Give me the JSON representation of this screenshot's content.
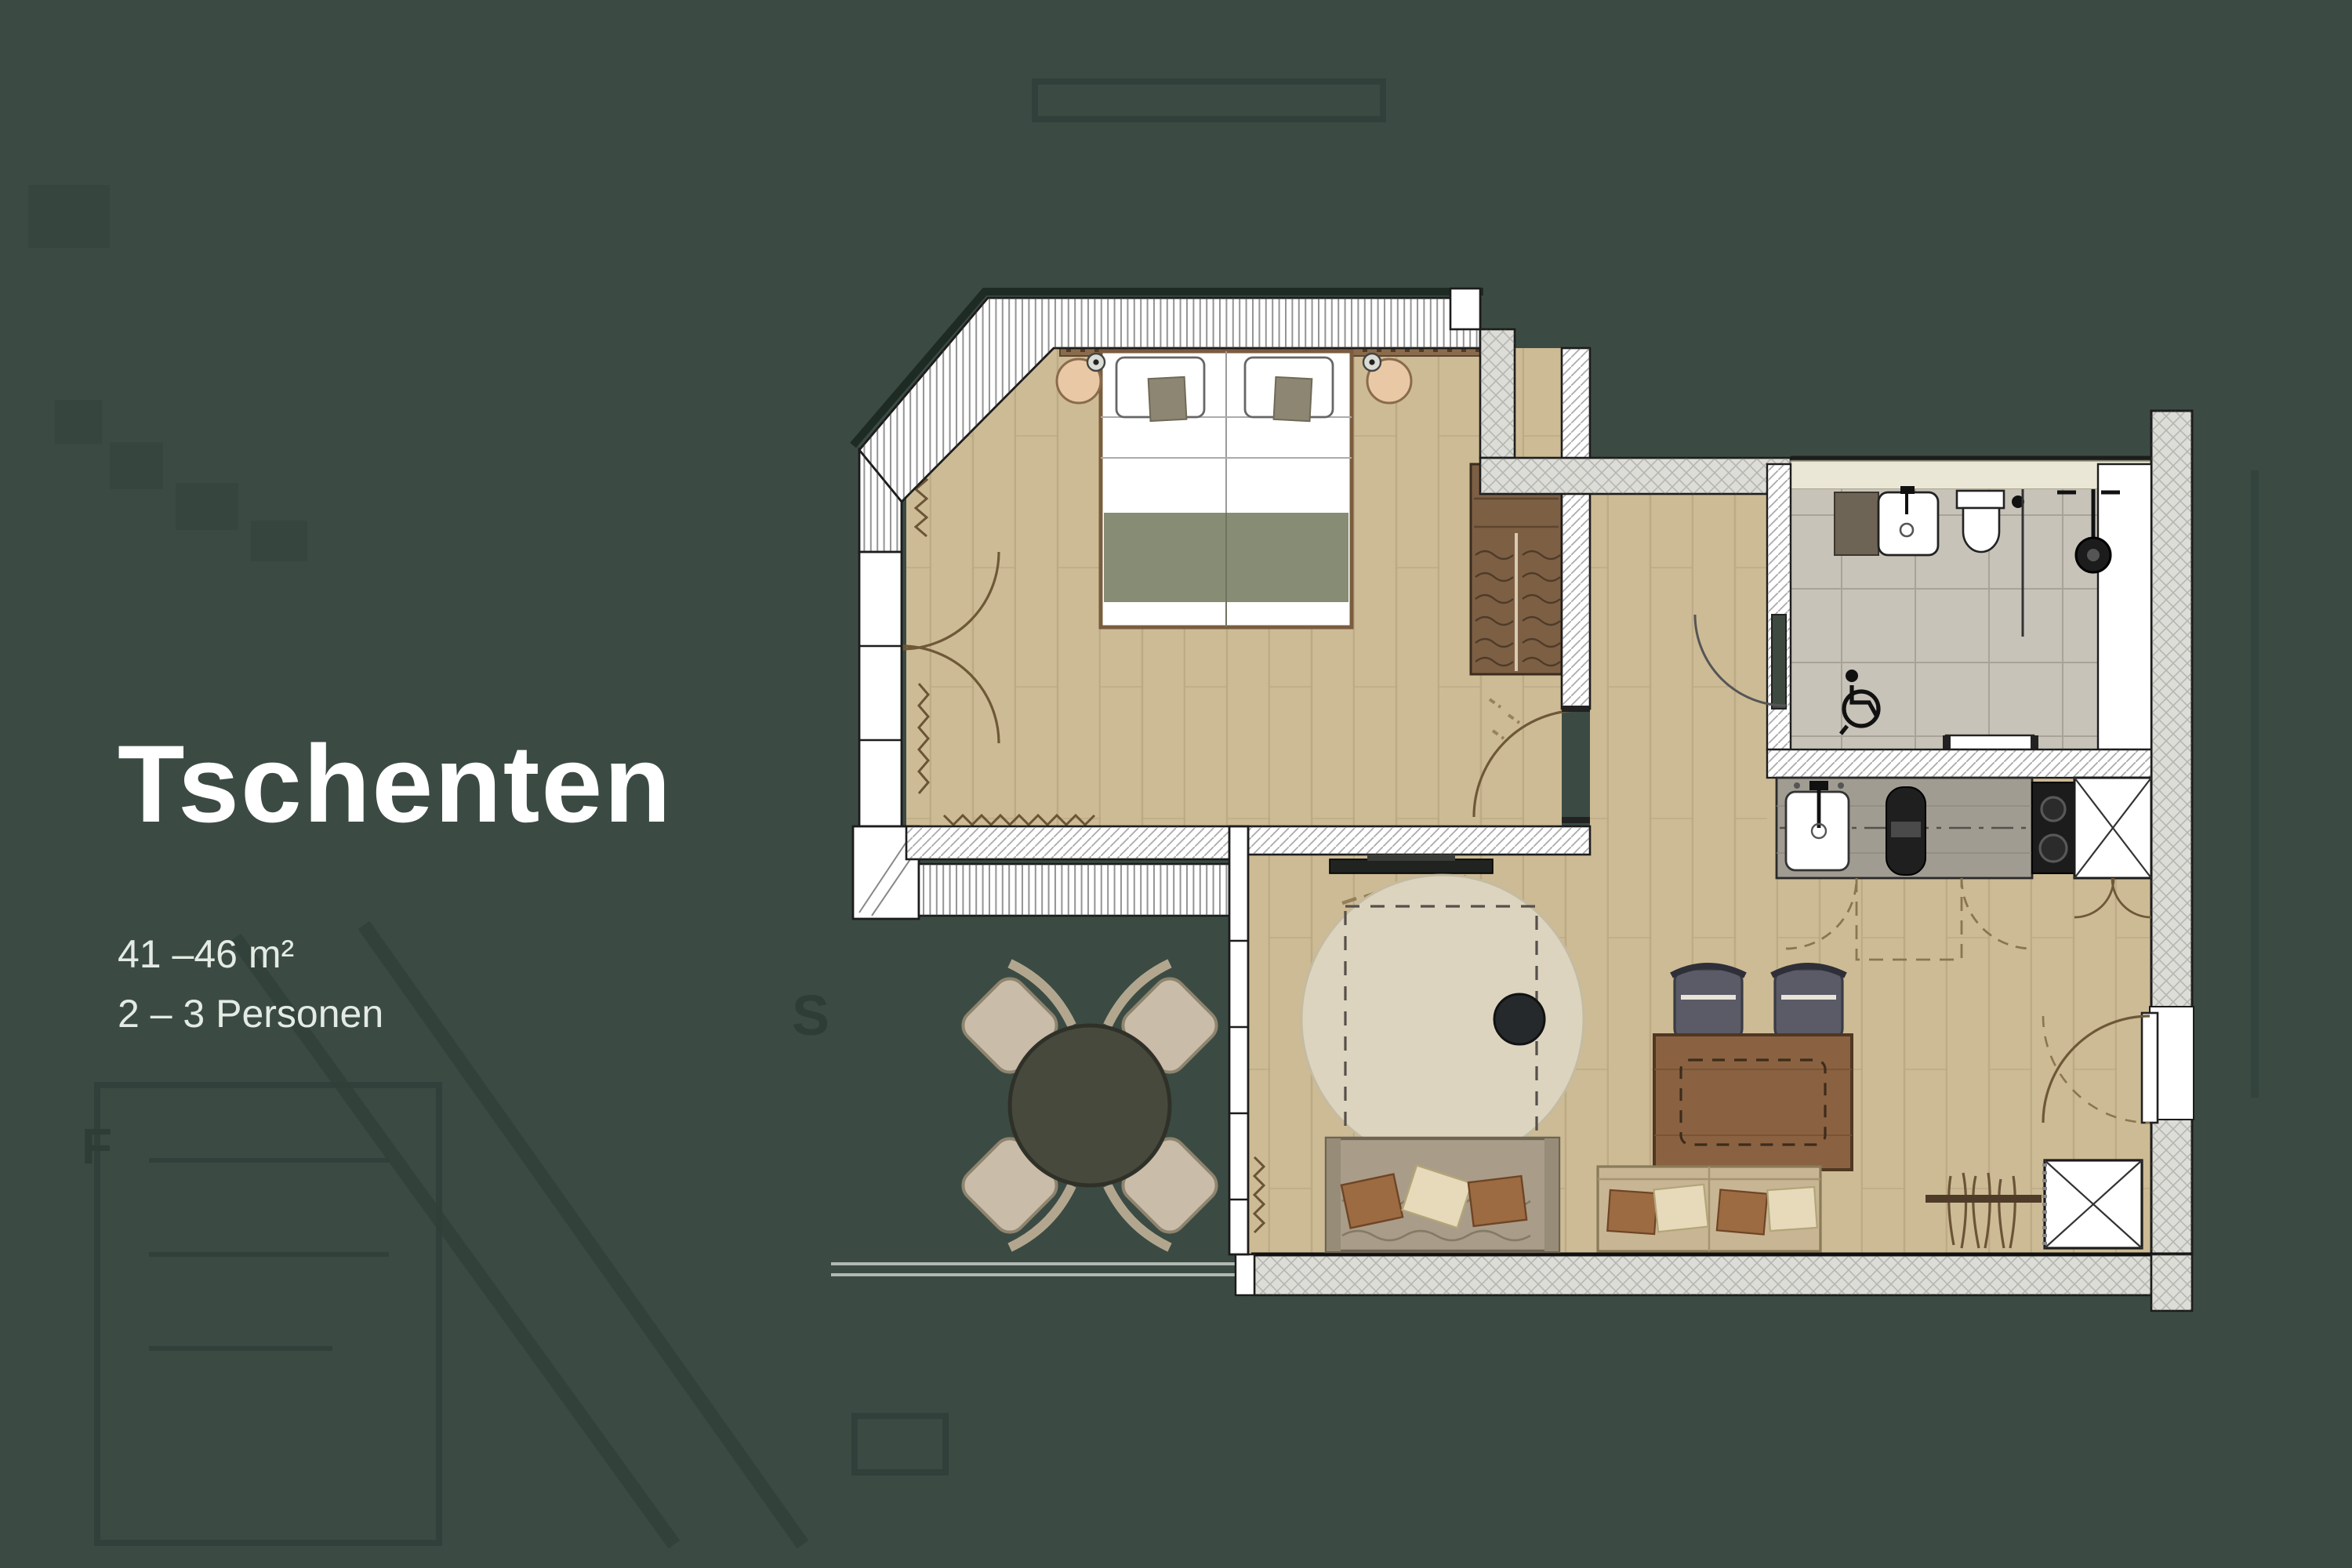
{
  "title": "Tschenten",
  "details": {
    "area": "41 –46 m²",
    "capacity": "2 – 3 Personen"
  },
  "site_ghost_labels": {
    "letter_s": "S",
    "letter_f": "F"
  },
  "colors": {
    "background": "#3B4B43",
    "title_text": "#FFFFFF",
    "subtitle_text": "#E3EBE4",
    "floor_wood": "#CDBB95",
    "floor_plank_line": "#B7A67F",
    "bathroom_tile": "#C8C3B9",
    "bathroom_ledge": "#EAE7D6",
    "wall_white": "#FFFFFF",
    "exterior_wall": "#DDDDD8",
    "blanket_olive": "#878D75",
    "wood_dark": "#7D5F44",
    "table_wood": "#8A6242",
    "chair_slate": "#5A5B66",
    "sofa": "#A99D89",
    "pillow_rust": "#9C6B42",
    "pillow_cream": "#E6DABB",
    "terrace_table": "#47493C",
    "terrace_chair": "#C9BCA8",
    "kitchen_counter": "#A19C92",
    "door_leaf_green": "#3E4A40",
    "nightstand": "#E9C9A5"
  }
}
